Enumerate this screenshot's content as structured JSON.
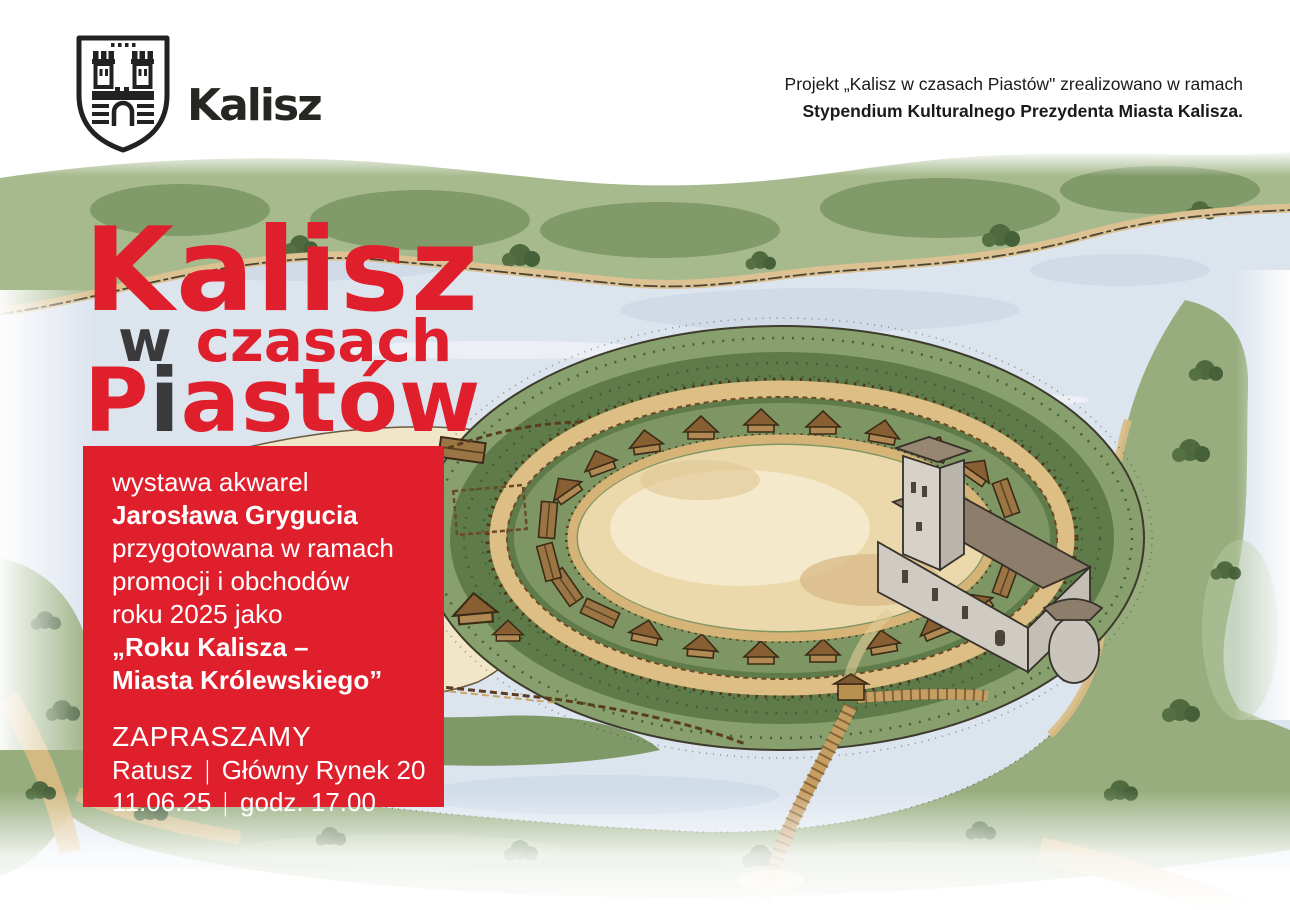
{
  "header": {
    "crest_city": "Kalisz",
    "credit_line1": "Projekt „Kalisz w czasach Piastów\" zrealizowano w ramach",
    "credit_line2": "Stypendium Kulturalnego Prezydenta Miasta Kalisza."
  },
  "title": {
    "line1": "Kalisz",
    "line2_w": "w",
    "line2_rest": "czasach",
    "line3_p": "P",
    "line3_i": "i",
    "line3_rest": "astów"
  },
  "details": {
    "line1": "wystawa akwarel",
    "line2": "Jarosława Grygucia",
    "line3": "przygotowana w ramach",
    "line4": "promocji i obchodów",
    "line5": "roku 2025 jako",
    "line6": "„Roku Kalisza –",
    "line7": "Miasta Królewskiego”",
    "invite": "ZAPRASZAMY",
    "venue_name": "Ratusz",
    "venue_sep": "|",
    "venue_address": "Główny Rynek 20",
    "date": "11.06.25",
    "time_sep": "|",
    "time": "godz. 17.00"
  },
  "colors": {
    "accent_red": "#e01f2c",
    "title_dark": "#3a3a3c",
    "text_on_red": "#ffffff",
    "ink_black": "#1b1a18",
    "river_blue": "#dce4ee",
    "bank_green": "#a7ba8e",
    "rampart_green": "#5e7b49",
    "sand": "#ebd8ab",
    "wood_brown": "#c79e62"
  },
  "illustration": {
    "subject": "watercolor aerial view of the medieval Kalisz ringfort with palisades, huts, stone church and a wooden bridge over the river"
  }
}
